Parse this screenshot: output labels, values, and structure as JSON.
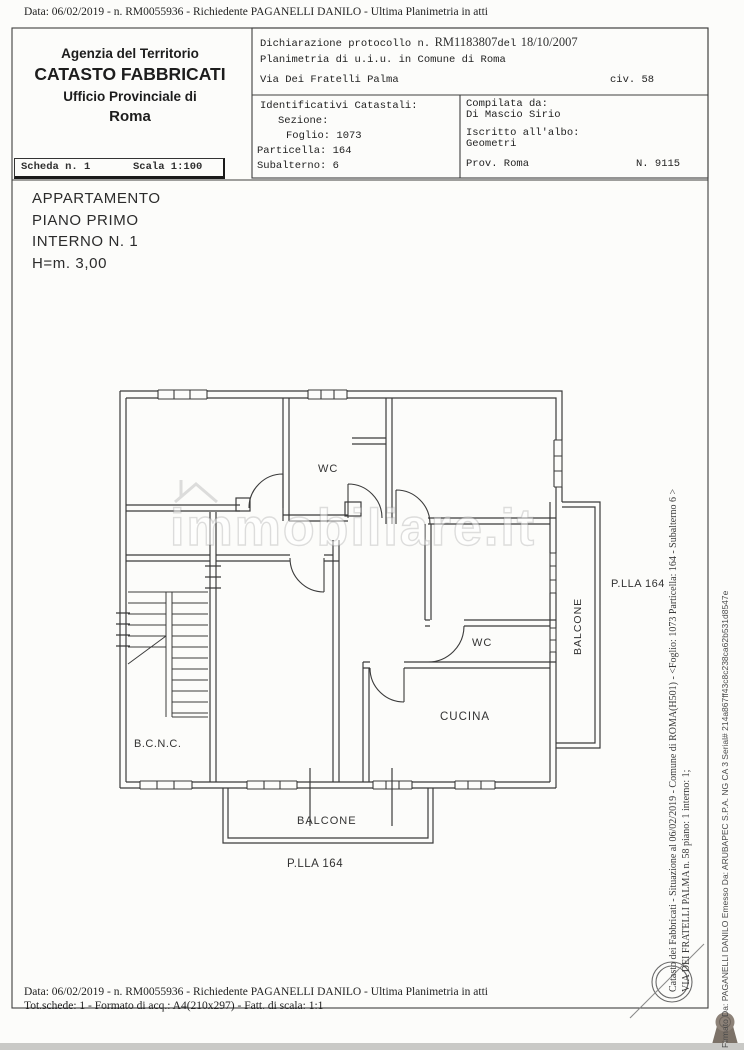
{
  "colors": {
    "ink": "#2f2f2f",
    "plan_line": "#3b3b3b",
    "paper": "#fcfcfa",
    "rosette": "#8d8278"
  },
  "page": {
    "data_line": "Data: 06/02/2019 -  n. RM0055936 - Richiedente PAGANELLI DANILO - Ultima Planimetria in atti",
    "footer_line": "Tot.schede:  1 - Formato di acq.:  A4(210x297) - Fatt. di scala:  1:1"
  },
  "header": {
    "agency": {
      "line1": "Agenzia del Territorio",
      "line2": "CATASTO FABBRICATI",
      "line3": "Ufficio Provinciale di",
      "line4": "Roma"
    },
    "declaration": {
      "protocol_label": "Dichiarazione protocollo n.",
      "protocol_number": "RM1183807",
      "protocol_del": "del",
      "protocol_date": "18/10/2007",
      "planimetria_line": "Planimetria di u.i.u. in Comune di Roma",
      "street": "Via Dei Fratelli Palma",
      "civ": "civ. 58"
    },
    "identifiers": {
      "title": "Identificativi Catastali:",
      "sezione": "Sezione:",
      "foglio": "Foglio: 1073",
      "particella": "Particella: 164",
      "subalterno": "Subalterno: 6"
    },
    "compiler": {
      "label": "Compilata da:",
      "name": "Di Mascio Sirio",
      "albo_label": "Iscritto all'albo:",
      "albo_value": "Geometri",
      "prov": "Prov. Roma",
      "reg_number": "N. 9115"
    }
  },
  "sheet": {
    "scheda": "Scheda n. 1",
    "scala": "Scala 1:100"
  },
  "apartment": {
    "line1": "APPARTAMENTO",
    "line2": "PIANO PRIMO",
    "line3": "INTERNO N. 1",
    "line4": "H=m. 3,00"
  },
  "plan": {
    "labels": {
      "wc_top": "WC",
      "wc_right": "WC",
      "cucina": "CUCINA",
      "bcnc": "B.C.N.C.",
      "balcone_right": "BALCONE",
      "balcone_bottom": "BALCONE",
      "parcel_right": "P.LLA 164",
      "parcel_bottom": "P.LLA 164"
    }
  },
  "watermark": {
    "text": "immobiliare.it"
  },
  "side_texts": {
    "cadastral_line": "Catasto dei Fabbricati - Situazione al 06/02/2019 - Comune di ROMA(H501) - <Foglio: 1073 Particella: 164 - Subalterno 6 >",
    "address_line": "VIA DEI FRATELLI PALMA n. 58 piano: 1 interno: 1;",
    "signature_line": "Firmato Da: PAGANELLI DANILO Emesso Da: ARUBAPEC S.P.A. NG CA 3 Serial# 214a867ff43c8c238ca62b531d8547e"
  },
  "icons": {
    "stamp": "notary-stamp-circle",
    "rosette": "ribbon-seal",
    "watermark_house": "house-roof"
  }
}
